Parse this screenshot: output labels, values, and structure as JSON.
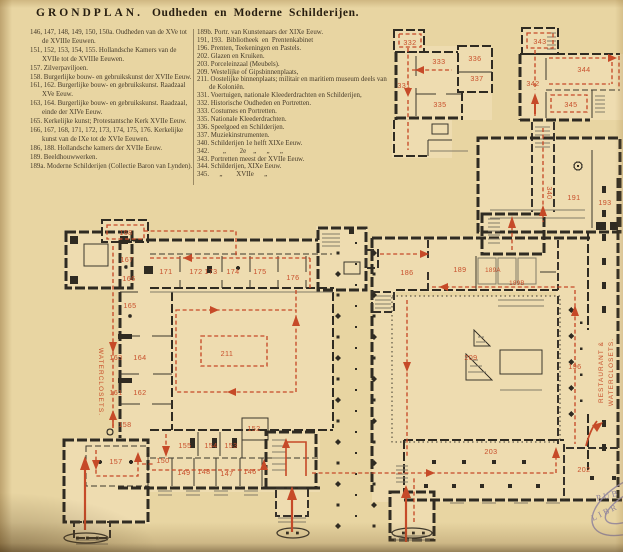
{
  "title": {
    "main": "GRONDPLAN.",
    "sub": "Oudheden en Moderne Schilderijen."
  },
  "legend": {
    "left": [
      "146, 147, 148, 149, 150, 150a. Oudheden van de XVe tot de XVIIIe Eeuwen.",
      "151, 152, 153, 154, 155. Hollandsche Kamers van de XVIIe tot de XVIIIe Eeuwen.",
      "157. Zilverpaviljoen.",
      "158. Burgerlijke bouw- en gebruikskunst der XVIIe Eeuw.",
      "161, 162. Burgerlijke bouw- en gebruikskunst. Raadzaal XVe Eeuw.",
      "163, 164. Burgerlijke bouw- en gebruikskunst. Raadzaal, einde der XIVe Eeuw.",
      "165. Kerkelijke kunst; Protestantsche Kerk XVIIe Eeuw.",
      "166, 167, 168, 171, 172, 173, 174, 175, 176. Kerkelijke kunst van de IXe tot de XVIe Eeuwen.",
      "186, 188. Hollandsche kamers der XVIIe Eeuw.",
      "189. Beeldhouwwerken.",
      "189a. Moderne Schilderijen (Collectie Baron van Lynden)."
    ],
    "right": [
      "189b. Portr. van Kunstenaars der XIXe Eeuw.",
      "191, 193.  Bibliotheek  en  Prentenkabinet",
      "196. Prenten, Teekeningen en Pastels.",
      "202. Glazen en Kruiken.",
      "203. Porceleinzaal (Meubels).",
      "209. Westelijke of Gipsbinnenplaats,",
      "211. Oostelijke binnenplaats; militair en maritiem museum deels van de Koloniën.",
      "331. Voertuigen, nationale Kleederdrachten en Schilderijen,",
      "332. Historische Oudheden en Portretten.",
      "333. Costumes en Portretten.",
      "335. Nationale Kleederdrachten.",
      "336. Speelgoed en Schilderijen.",
      "337. Muziekinstrumenten.",
      "340. Schilderijen 1e helft XIXe Eeuw.",
      "342.        „        2e    „      „      „",
      "343. Portretten meest der XVIIe Eeuw.",
      "344. Schilderijen, XIXe Eeuw.",
      "345.      „        XVIIe      „"
    ]
  },
  "plan": {
    "rooms": {
      "146": "146",
      "147": "147",
      "148": "148",
      "149": "149",
      "150": "150",
      "152": "152",
      "153": "153",
      "154": "154",
      "155": "155",
      "157": "157",
      "158": "158",
      "161": "161",
      "162": "162",
      "163": "163",
      "164": "164",
      "165": "165",
      "166": "166",
      "167": "167",
      "168": "168",
      "171": "171",
      "172": "172",
      "173": "173",
      "174": "174",
      "175": "175",
      "176": "176",
      "186": "186",
      "189": "189",
      "189a": "189A",
      "189b": "189B",
      "191": "191",
      "193": "193",
      "196": "196",
      "202": "202",
      "203": "203",
      "209": "209",
      "211": "211",
      "331": "331",
      "332": "332",
      "333": "333",
      "335": "335",
      "336": "336",
      "337": "337",
      "340": "340",
      "342": "342",
      "343": "343",
      "344": "344",
      "345": "345"
    },
    "texts": {
      "wc_west": "WATERCLOSETS.",
      "restaurant_line1": "RESTAURANT &",
      "restaurant_line2": "WATERCLOSETS."
    },
    "stamp": {
      "l1": "PUB",
      "l2": "LIBR"
    }
  },
  "colors": {
    "paper": "#e8d5a2",
    "wall_ink": "#2f2b22",
    "route_red": "#c64a28",
    "stamp_purple": "#93879f"
  }
}
